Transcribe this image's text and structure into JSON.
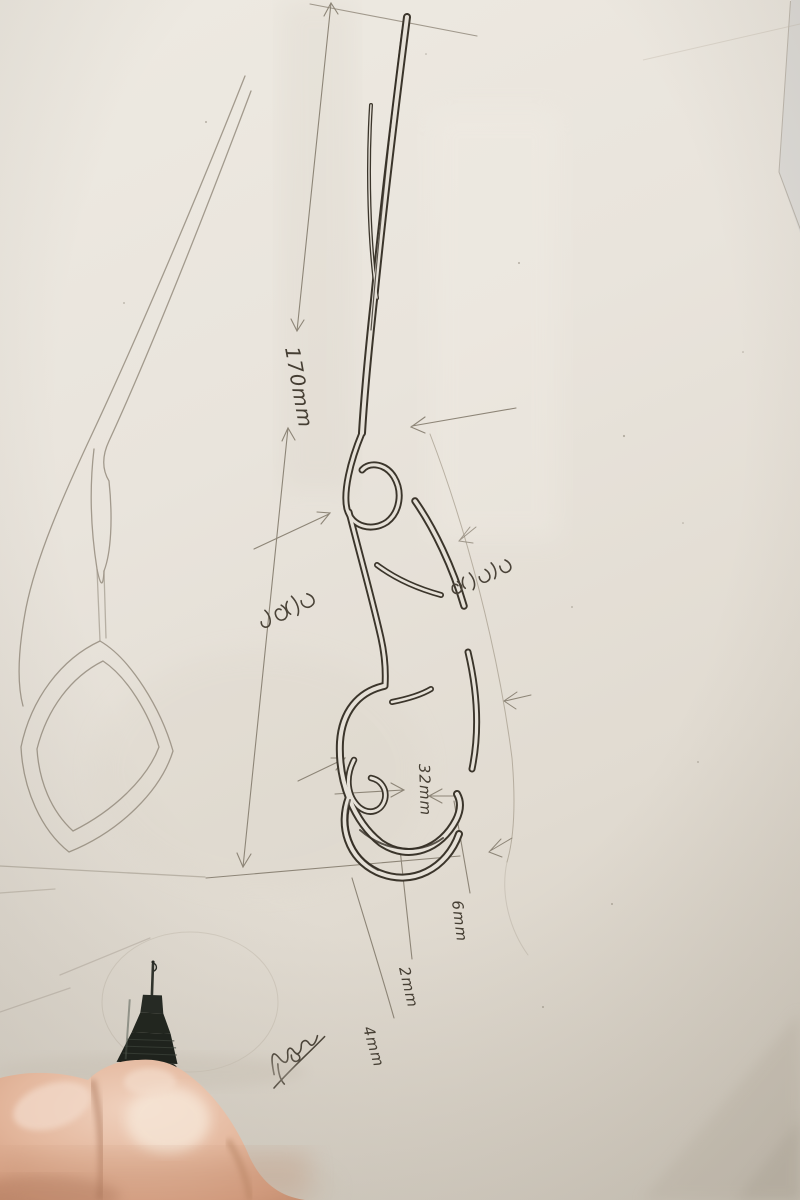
{
  "scene": {
    "type": "photograph",
    "subject": "Hand-drawn ornamental hairpin design sketch on paper; a hand holds a black fineliner pen at bottom left"
  },
  "labels": {
    "overall_length": "170mm",
    "opening_width": "32mm",
    "detail_6mm": "6mm",
    "detail_2mm": "2mm",
    "detail_4mm": "4mm"
  },
  "handwritten_notes": {
    "note_left": "two-character cursive note (illegible)",
    "note_right": "two-character cursive note (illegible)",
    "signature": "cursive signature scribble (illegible)"
  },
  "colors": {
    "paper": "#e7e2d9",
    "ink": "#3b352b",
    "pencil": "#968d7f",
    "pen_body": "#20241e",
    "skin": "#e2b69c",
    "under_sheet": "#dddbd7"
  }
}
